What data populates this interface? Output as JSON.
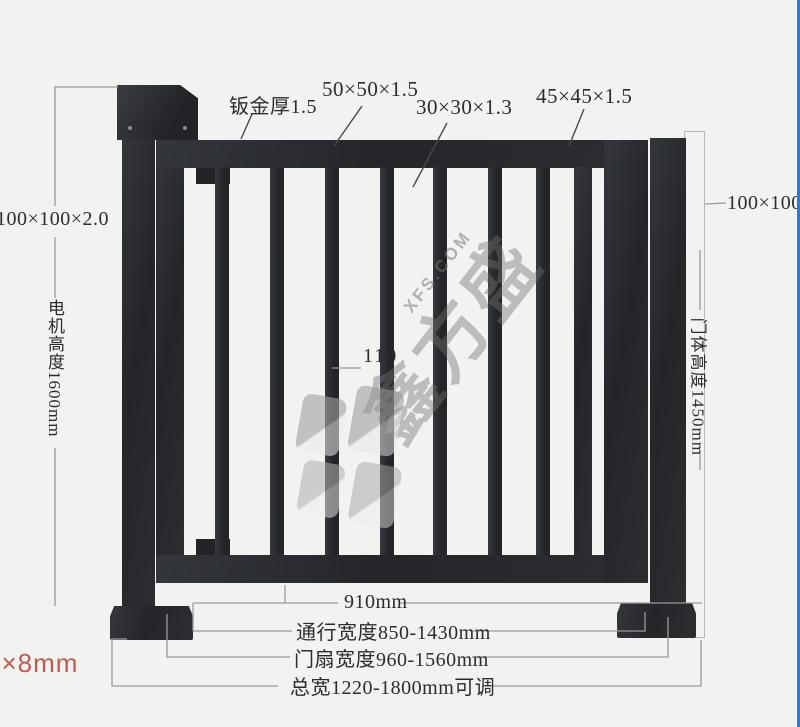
{
  "drawing": {
    "type": "gate-dimension-diagram",
    "annotations": {
      "sheet_thickness": "钣金厚1.5",
      "frame_tube": "50×50×1.5",
      "picket_tube": "30×30×1.3",
      "leaf_edge_tube": "45×45×1.5",
      "left_post_spec": "100×100×2.0",
      "right_post_spec": "100×100",
      "motor_height": "电机高度1600mm",
      "door_height": "门体高度1450mm",
      "picket_gap": "110",
      "opening_width": "910mm",
      "passage_width": "通行宽度850-1430mm",
      "leaf_width": "门扇宽度960-1560mm",
      "total_width": "总宽1220-1800mm可调",
      "anchor_note": "0×8mm"
    }
  },
  "watermark": {
    "site": "XFS.COM",
    "brand": "鑫方盛"
  },
  "colors": {
    "background": "#f2f2f0",
    "metal": "#26282c",
    "dimension_line": "#9a9a9a",
    "leader_line": "#4a4a4a",
    "label_text": "#2c2c2c",
    "anchor_text": "#c05a50",
    "edge_accent_blue": "#2e7ad3",
    "watermark_gray": "#787878"
  }
}
